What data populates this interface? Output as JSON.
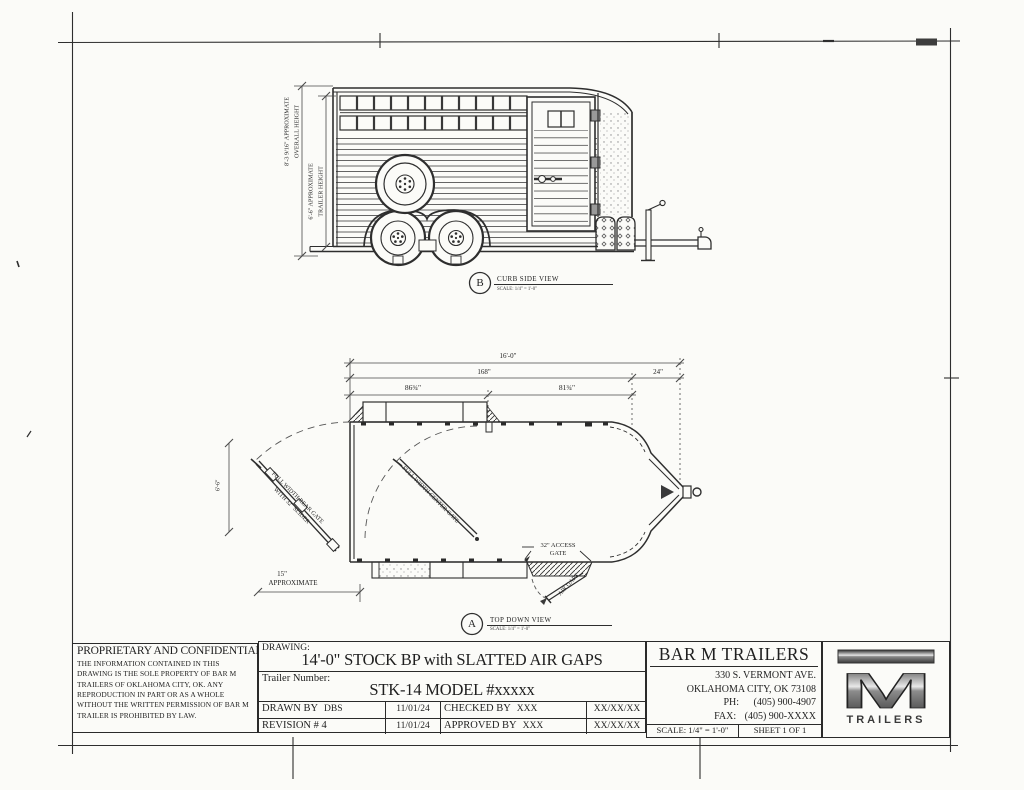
{
  "page": {
    "paper_color": "#fbfbf8",
    "ink_color": "#2e2e2e"
  },
  "side_view": {
    "view_letter": "B",
    "view_title": "CURB SIDE VIEW",
    "view_scale": "SCALE: 1/4\" = 1'-0\"",
    "overall_height_line1": "8'-3 9/16\" APPROXIMATE",
    "overall_height_line2": "OVERALL HEIGHT",
    "trailer_height_line1": "6'-6\" APPROXIMATE",
    "trailer_height_line2": "TRAILER HEIGHT"
  },
  "top_view": {
    "view_letter": "A",
    "view_title": "TOP DOWN VIEW",
    "view_scale": "SCALE: 1/4\" = 1'-0\"",
    "dim_overall_length": "16'-0\"",
    "dim_box_length": "168\"",
    "dim_tongue_length": "24\"",
    "dim_front_compartment": "86¾\"",
    "dim_rear_compartment": "81¾\"",
    "dim_rear_clearance_line1": "15\"",
    "dim_rear_clearance_line2": "APPROXIMATE",
    "dim_width": "6'-6\"",
    "rear_gate_label_line1": "FULL WIDTH REAR GATE",
    "rear_gate_label_line2": "WITH 32\" SLIDER",
    "center_gate_label": "FULL WIDTH CENTER GATE",
    "access_gate_label_line1": "32\" ACCESS",
    "access_gate_label_line2": "GATE",
    "air_gaps_label": "AIR GAPS"
  },
  "title_block": {
    "proprietary_heading": "PROPRIETARY AND CONFIDENTIAL",
    "proprietary_body": "THE INFORMATION CONTAINED IN THIS DRAWING IS THE SOLE PROPERTY OF BAR M TRAILERS OF OKLAHOMA CITY, OK. ANY REPRODUCTION IN PART OR AS A WHOLE WITHOUT THE WRITTEN PERMISSION OF BAR M TRAILER IS PROHIBITED BY LAW.",
    "drawing_label": "DRAWING:",
    "drawing_value": "14'-0\" STOCK BP with SLATTED AIR GAPS",
    "trailer_number_label": "Trailer Number:",
    "trailer_number_value": "STK-14 MODEL #xxxxx",
    "drawn_by_label": "DRAWN BY",
    "drawn_by_value": "DBS",
    "drawn_date": "11/01/24",
    "checked_by_label": "CHECKED BY",
    "checked_by_value": "XXX",
    "checked_date": "XX/XX/XX",
    "revision_label": "REVISION # 4",
    "revision_date": "11/01/24",
    "approved_by_label": "APPROVED BY",
    "approved_by_value": "XXX",
    "approved_date": "XX/XX/XX",
    "company_name": "BAR M TRAILERS",
    "company_address1": "330 S. VERMONT AVE.",
    "company_address2": "OKLAHOMA CITY, OK 73108",
    "phone_label": "PH:",
    "phone_value": "(405) 900-4907",
    "fax_label": "FAX:",
    "fax_value": "(405) 900-XXXX",
    "scale_note": "SCALE: 1/4\" = 1'-0\"",
    "sheet_note": "SHEET 1 OF 1",
    "logo_monogram": "M",
    "logo_word": "TRAILERS"
  }
}
